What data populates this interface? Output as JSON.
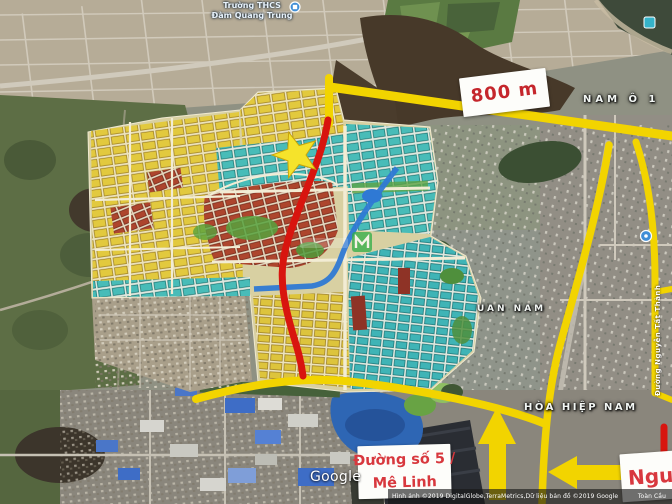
{
  "labels": {
    "school": {
      "line1": "Trường THCS",
      "line2": "Đàm Quang Trung"
    },
    "districts": {
      "nam_o": "NAM Ô 1",
      "uan_nam": "UAN NAM",
      "hoa_hiep_nam": "HÒA HIỆP NAM"
    }
  },
  "annotations": {
    "distance": "800 m",
    "road5_line1": "Đường số 5 /",
    "road5_line2": "Mê Linh",
    "partial": "Ngu",
    "coastal_road": "Đường Nguyễn Tất Thành"
  },
  "attribution": {
    "logo": "Google",
    "copyright": "Hình ảnh ©2019 DigitalGlobe,TerraMetrics,Dữ liệu bản đồ ©2019 Google",
    "region": "Toàn Cầu"
  },
  "icons": {
    "star_marker": "five-point-star",
    "arrow_up": "▲",
    "arrow_left": "◀",
    "school_marker": "blue-circle-poi",
    "poi_marker_topright": "cyan-square-poi",
    "poi_marker_right": "blue-circle-poi",
    "watermark_logo": "green-M-logo"
  },
  "colors": {
    "annotation_yellow": "#F2D400",
    "route_red": "#D8150F",
    "label_red": "#C5262C",
    "plan_yellow": "#E2C93E",
    "plan_teal": "#48BCB8",
    "plan_brick": "#AD452D",
    "canal_blue": "#2F79D4",
    "lagoon_blue": "#2E66B4"
  }
}
